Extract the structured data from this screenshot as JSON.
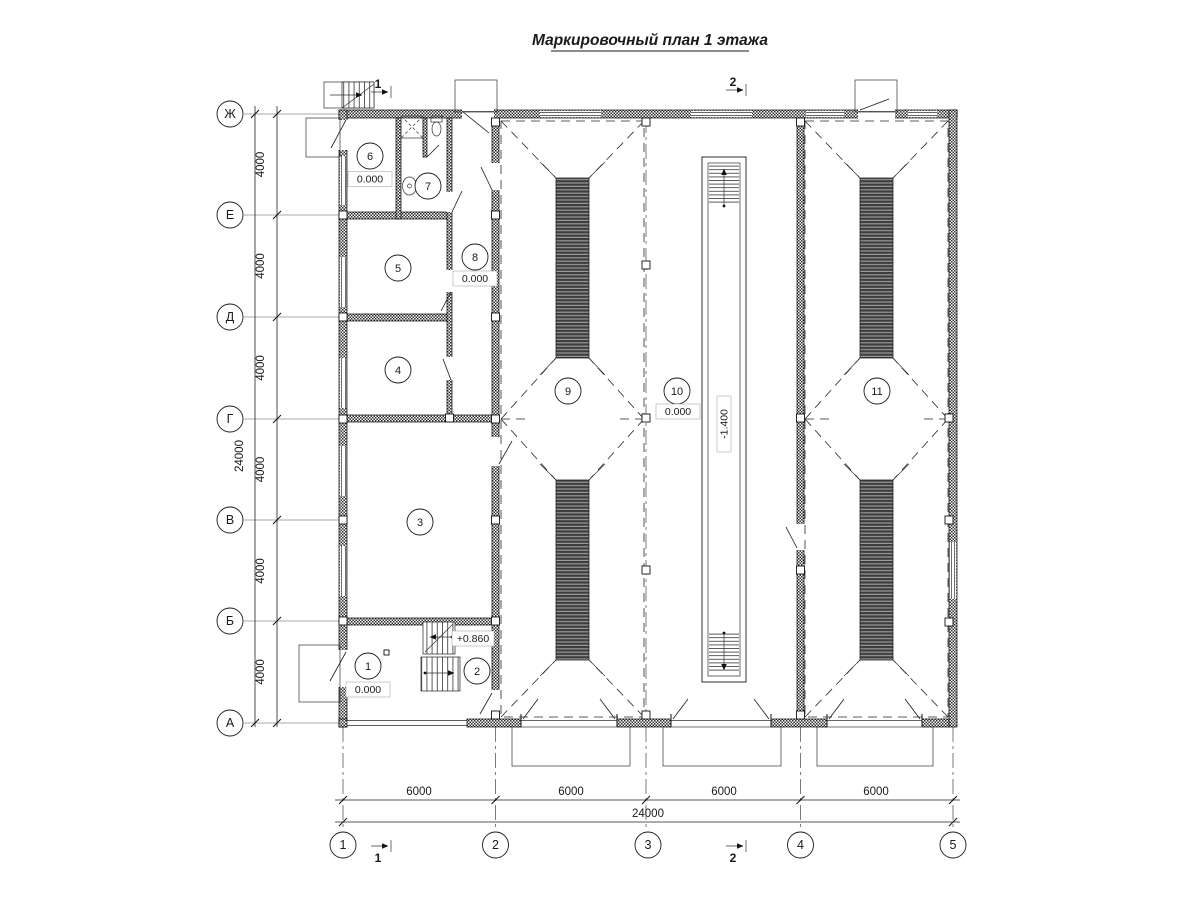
{
  "title": "Маркировочный план 1 этажа",
  "axes": {
    "rows": [
      "Ж",
      "Е",
      "Д",
      "Г",
      "В",
      "Б",
      "А"
    ],
    "cols": [
      "1",
      "2",
      "3",
      "4",
      "5"
    ]
  },
  "dims": {
    "left": [
      "4000",
      "4000",
      "4000",
      "4000",
      "4000",
      "4000"
    ],
    "left_total": "24000",
    "bottom": [
      "6000",
      "6000",
      "6000",
      "6000"
    ],
    "bottom_total": "24000"
  },
  "rooms": [
    {
      "number": "1"
    },
    {
      "number": "2"
    },
    {
      "number": "3"
    },
    {
      "number": "4"
    },
    {
      "number": "5"
    },
    {
      "number": "6"
    },
    {
      "number": "7"
    },
    {
      "number": "8"
    },
    {
      "number": "9"
    },
    {
      "number": "10"
    },
    {
      "number": "11"
    }
  ],
  "elevations": {
    "room1": "0.000",
    "room6": "0.000",
    "room8": "0.000",
    "room10": "0.000",
    "stair_landing": "+0.860",
    "ramp_pit": "-1.400"
  },
  "sections": {
    "top": [
      {
        "label": "1"
      },
      {
        "label": "2"
      }
    ],
    "bottom": [
      {
        "label": "1"
      },
      {
        "label": "2"
      }
    ]
  }
}
